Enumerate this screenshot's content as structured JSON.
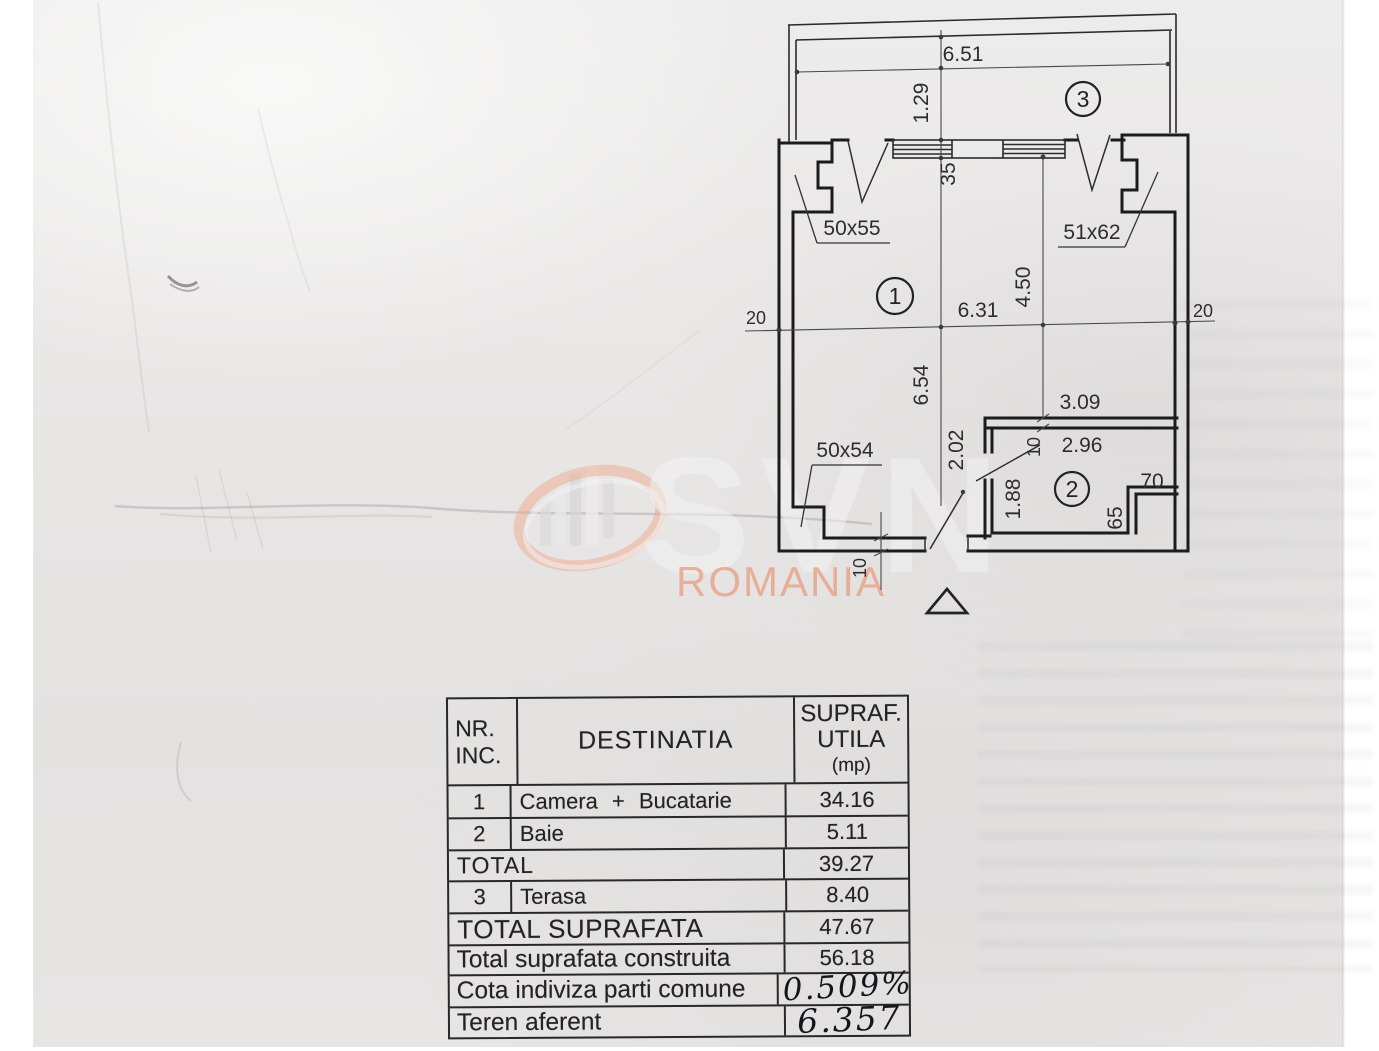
{
  "watermark": {
    "brand": "SVN",
    "region": "ROMANIA"
  },
  "plan": {
    "room_labels": {
      "room1": "1",
      "room2": "2",
      "room3": "3"
    },
    "window_labels": {
      "left": "50x55",
      "right": "51x62",
      "bottom": "50x54"
    },
    "dimensions": {
      "terrace_width": "6.51",
      "terrace_depth": "1.29",
      "window_axis_offset": "35",
      "room_width": "6.31",
      "room_depth_right": "4.50",
      "room_depth_left": "6.54",
      "axis_left": "20",
      "axis_right": "20",
      "bath_width_outer": "3.09",
      "bath_width_inner": "2.96",
      "door_wall": "2.02",
      "bath_depth": "1.88",
      "wall_thickness_top": "10",
      "wall_thickness_bottom": "10",
      "shaft_width": "70",
      "shaft_depth": "65"
    }
  },
  "table": {
    "header": {
      "col1a": "NR.",
      "col1b": "INC.",
      "col2": "DESTINATIA",
      "col3a": "SUPRAF.",
      "col3b": "UTILA",
      "col3c": "(mp)"
    },
    "rows": [
      {
        "nr": "1",
        "dest": "Camera + Bucatarie",
        "value": "34.16"
      },
      {
        "nr": "2",
        "dest": "Baie",
        "value": "5.11"
      },
      {
        "nr": "",
        "dest": "TOTAL",
        "value": "39.27"
      },
      {
        "nr": "3",
        "dest": "Terasa",
        "value": "8.40"
      },
      {
        "nr": "",
        "dest": "TOTAL SUPRAFATA",
        "value": "47.67"
      }
    ],
    "summary_rows": [
      {
        "label": "Total suprafata construita",
        "value": "56.18"
      },
      {
        "label": "Cota indiviza parti comune",
        "value": "0.509%"
      },
      {
        "label": "Teren aferent",
        "value": "6.357"
      }
    ]
  },
  "colors": {
    "watermark_accent": "#eca88c",
    "ink": "#1e1e20",
    "paper": "#e8e6e5"
  }
}
